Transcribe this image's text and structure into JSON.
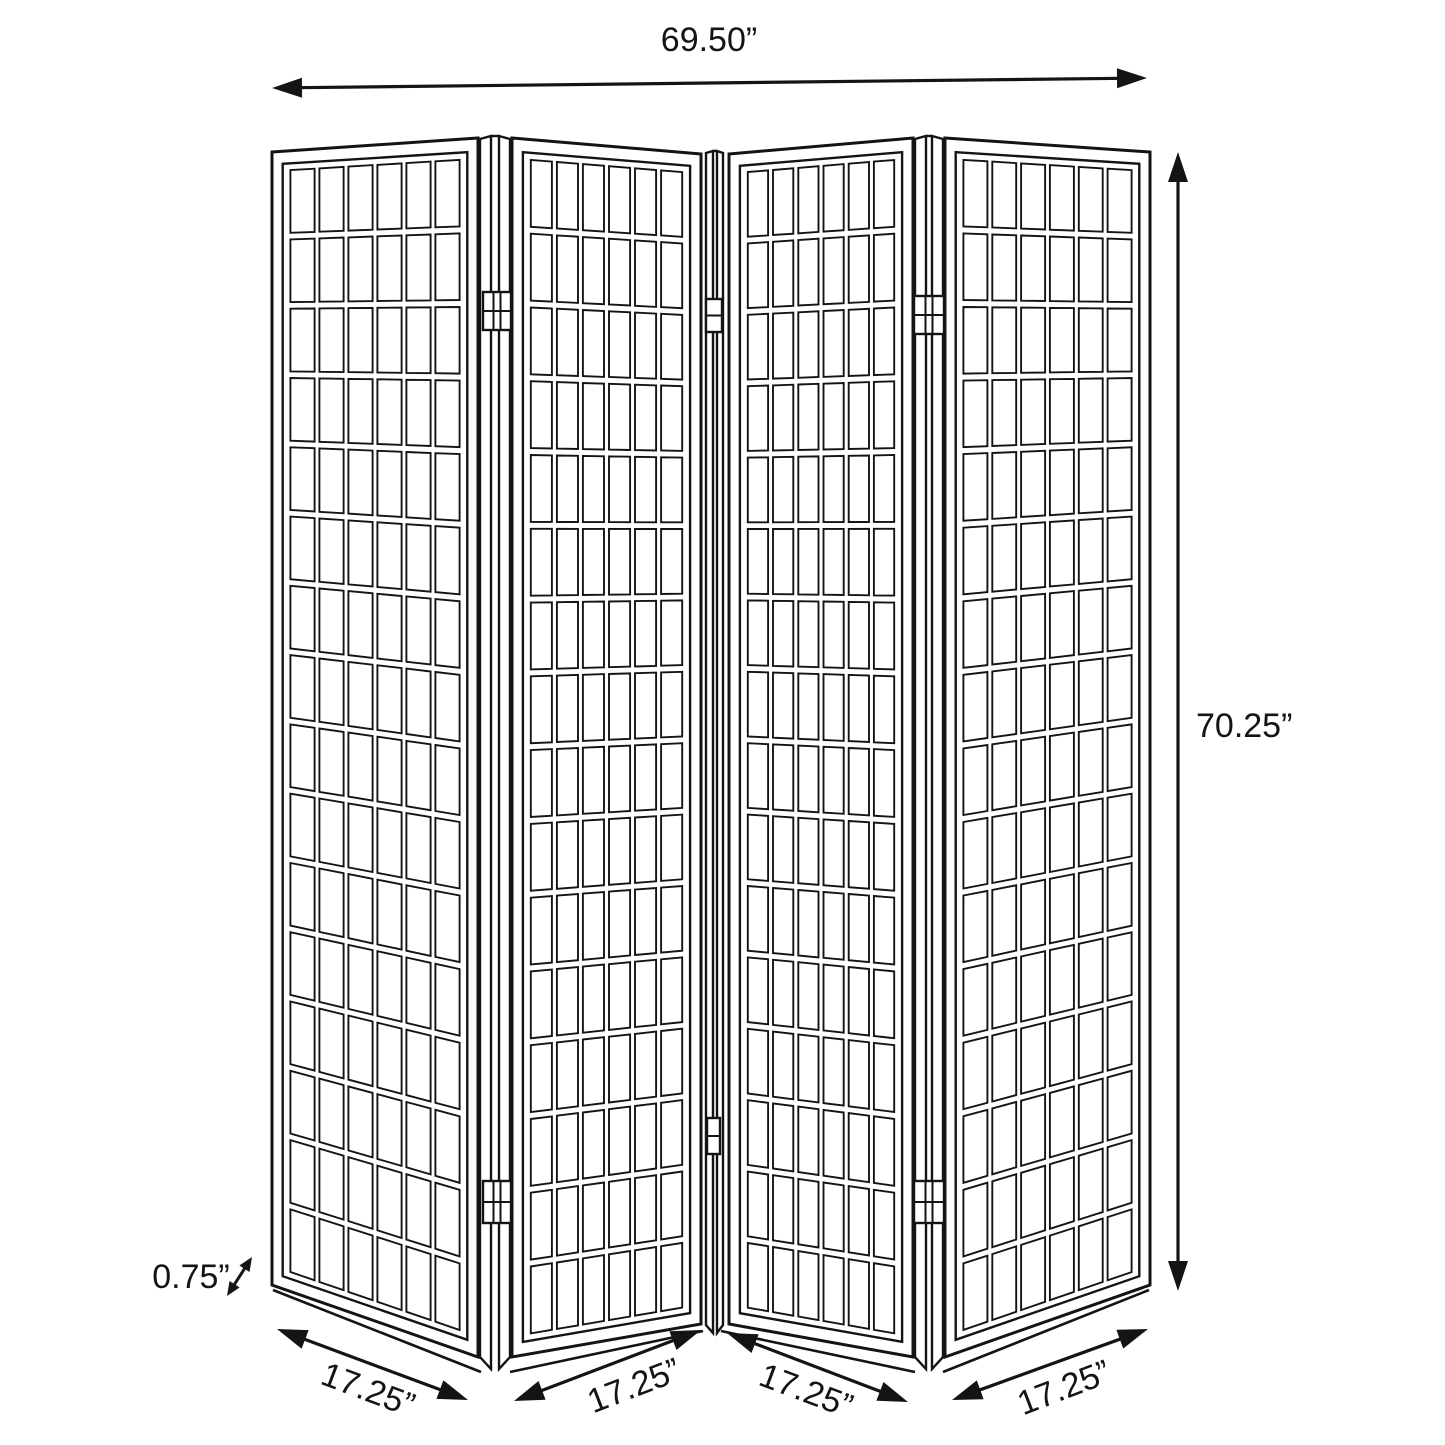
{
  "diagram": {
    "subject": "4-panel folding shoji screen room divider dimension drawing",
    "style": {
      "background": "#ffffff",
      "line_color": "#141414"
    },
    "dimensions": {
      "overall_width": "69.50”",
      "overall_height": "70.25”",
      "panel_thickness": "0.75”",
      "panel_width_labels": [
        "17.25”",
        "17.25”",
        "17.25”",
        "17.25”"
      ]
    },
    "structure": {
      "panel_count": 4,
      "grid_columns_per_panel": 6,
      "grid_rows_per_panel": 16,
      "hinge_pairs": 3
    }
  }
}
